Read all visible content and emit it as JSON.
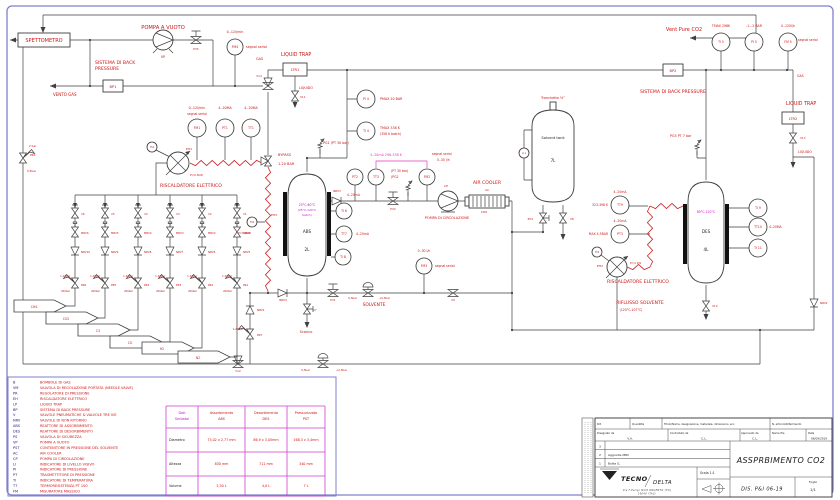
{
  "sheet": {
    "width": 840,
    "height": 500,
    "drawing_number": "DIS. P&I 06-19",
    "drawing_title": "ASSPRBIMENTO CO2"
  },
  "colors": {
    "line": "#3f3f3f",
    "r": "#cc1414",
    "m": "#c213c2",
    "p": "#e23bbf",
    "k": "#1c1c1c",
    "n": "#20207a",
    "border": "#8080cc"
  },
  "labels": [
    [
      "SPETTOMETRO",
      44,
      42,
      "r",
      5,
      "m"
    ],
    [
      "POMPA A VUOTO",
      163,
      29,
      "r",
      5.2,
      "m"
    ],
    [
      "VP",
      163,
      58,
      "r",
      3.4,
      "m"
    ],
    [
      "PV5",
      196,
      50,
      "r",
      2.8,
      "m"
    ],
    [
      "0..12l/min",
      235,
      33,
      "r",
      3.3,
      "m"
    ],
    [
      "segnal serial",
      246,
      48,
      "r",
      3.3,
      "s"
    ],
    [
      "SISTEMA DI BACK",
      95,
      64,
      "r",
      4.6,
      "s"
    ],
    [
      "PRESSURE",
      95,
      70,
      "r",
      4.6,
      "s"
    ],
    [
      "BP1",
      113,
      88,
      "r",
      3.6,
      "m"
    ],
    [
      "VENTO GAS",
      53,
      96,
      "r",
      4,
      "s"
    ],
    [
      "2 bar",
      29,
      147,
      "r",
      2.8,
      "s"
    ],
    [
      "PR0",
      30,
      156,
      "r",
      2.8,
      "s"
    ],
    [
      "0,5bar",
      27,
      172,
      "r",
      2.8,
      "s"
    ],
    [
      "GAS",
      256,
      60,
      "r",
      3.4,
      "s"
    ],
    [
      "LIQUID TRAP",
      281,
      56,
      "r",
      4.8,
      "s"
    ],
    [
      "LTR1",
      295,
      71,
      "r",
      3.6,
      "m"
    ],
    [
      "LIQUIDO",
      299,
      89,
      "r",
      3.3,
      "s"
    ],
    [
      "V11",
      300,
      98,
      "r",
      2.8,
      "s"
    ],
    [
      "V14",
      259,
      77,
      "r",
      2.8,
      "m"
    ],
    [
      "BYPASS",
      278,
      156,
      "r",
      3.5,
      "s"
    ],
    [
      "1-20 BAR",
      278,
      165,
      "r",
      3.5,
      "s"
    ],
    [
      "PG1 (PT 30 bar)",
      323,
      144,
      "r",
      3.3,
      "s"
    ],
    [
      "PMAX 20 BAR",
      380,
      100,
      "r",
      3.3,
      "s"
    ],
    [
      "TMAX 338 K",
      380,
      129,
      "r",
      3.3,
      "s"
    ],
    [
      "(358 K batch)",
      380,
      135,
      "r",
      3.1,
      "s"
    ],
    [
      "0..12l/min",
      197,
      109,
      "r",
      3.3,
      "m"
    ],
    [
      "segnal serial",
      197,
      115,
      "r",
      3.1,
      "m"
    ],
    [
      "4..20MA",
      225,
      109,
      "r",
      3.3,
      "m"
    ],
    [
      "4..20MA",
      251,
      109,
      "r",
      3.3,
      "m"
    ],
    [
      "RISCALDATORE ELETTRICO",
      160,
      187,
      "r",
      4.6,
      "s"
    ],
    [
      "EH1",
      186,
      150,
      "r",
      3,
      "s"
    ],
    [
      "P=0,5kW",
      190,
      176,
      "r",
      2.8,
      "s"
    ],
    [
      "EH3",
      271,
      216,
      "r",
      3,
      "s"
    ],
    [
      "P=1,0kW",
      238,
      234,
      "r",
      2.8,
      "s"
    ],
    [
      "Vent Pure CO2",
      684,
      31,
      "r",
      5,
      "m"
    ],
    [
      "TMAX 298K",
      721,
      27,
      "r",
      3.2,
      "m"
    ],
    [
      "-1...2 BAR",
      754,
      27,
      "r",
      3.2,
      "m"
    ],
    [
      "0..120l/h",
      788,
      27,
      "r",
      3.2,
      "m"
    ],
    [
      "segnal serial",
      798,
      41,
      "r",
      3.1,
      "s"
    ],
    [
      "BP2",
      673,
      72,
      "r",
      3.6,
      "m"
    ],
    [
      "SISTEMA DI BACK PRESSURE",
      640,
      93,
      "r",
      4.6,
      "s"
    ],
    [
      "GAS",
      797,
      77,
      "r",
      3.2,
      "s"
    ],
    [
      "LIQUID TRAP",
      786,
      105,
      "r",
      4.8,
      "s"
    ],
    [
      "LTR2",
      793,
      120,
      "r",
      3.6,
      "m"
    ],
    [
      "V13",
      800,
      139,
      "r",
      2.8,
      "s"
    ],
    [
      "LIQUIDO",
      798,
      153,
      "r",
      3.3,
      "s"
    ],
    [
      "Tronchetto ½”",
      553,
      99,
      "r",
      3.4,
      "m"
    ],
    [
      "Solvent tank",
      553,
      139,
      "k",
      3.7,
      "m"
    ],
    [
      "7L",
      553,
      162,
      "k",
      4,
      "m"
    ],
    [
      "PG3  PT 7 bar",
      670,
      137,
      "r",
      3.3,
      "s"
    ],
    [
      "PV4",
      533,
      220,
      "r",
      2.8,
      "e"
    ],
    [
      "V8",
      570,
      220,
      "r",
      2.8,
      "s"
    ],
    [
      "NRV3",
      337,
      192,
      "r",
      2.8,
      "m"
    ],
    [
      "4..20mA",
      347,
      196,
      "r",
      3.1,
      "s"
    ],
    [
      "(PT 30 bar)",
      391,
      172,
      "r",
      3.1,
      "s"
    ],
    [
      "(PG2",
      391,
      178,
      "r",
      3.1,
      "s"
    ],
    [
      "4..20mA  298-338 K",
      370,
      156,
      "p",
      3.3,
      "s"
    ],
    [
      "segnal serial",
      432,
      155,
      "r",
      3.1,
      "s"
    ],
    [
      "0..30 l/h",
      437,
      161,
      "r",
      3.1,
      "s"
    ],
    [
      "PV2",
      393,
      210,
      "r",
      2.8,
      "m"
    ],
    [
      "CP",
      446,
      187,
      "r",
      3,
      "m"
    ],
    [
      "POMPA DI CIRCOLAZIONE",
      447,
      219,
      "r",
      3.5,
      "m"
    ],
    [
      "AIR COOLER",
      487,
      184,
      "r",
      4.6,
      "m"
    ],
    [
      "AC",
      487,
      191,
      "r",
      2.9,
      "m"
    ],
    [
      "CHO",
      484,
      213,
      "r",
      2.9,
      "m"
    ],
    [
      "25°C-60°C",
      307,
      206,
      "m",
      3.1,
      "m"
    ],
    [
      "(25°C-120°C",
      307,
      211,
      "m",
      2.9,
      "m"
    ],
    [
      "batch)",
      307,
      216,
      "m",
      2.9,
      "m"
    ],
    [
      "ABS",
      307,
      233,
      "k",
      4.1,
      "m"
    ],
    [
      "2L",
      307,
      251,
      "k",
      4.1,
      "m"
    ],
    [
      "80°C-120°C",
      706,
      213,
      "m",
      3.1,
      "m"
    ],
    [
      "DES",
      706,
      233,
      "k",
      4.1,
      "m"
    ],
    [
      "4L",
      706,
      251,
      "k",
      4.1,
      "m"
    ],
    [
      "4..20mA",
      356,
      235,
      "r",
      3.1,
      "s"
    ],
    [
      "NRV4",
      283,
      301,
      "r",
      2.8,
      "m"
    ],
    [
      "V7",
      313,
      311,
      "r",
      2.8,
      "s"
    ],
    [
      "Scarico",
      306,
      333,
      "r",
      3.5,
      "m"
    ],
    [
      "PV1",
      333,
      301,
      "r",
      2.8,
      "m"
    ],
    [
      "0,5bar",
      357,
      299,
      "r",
      2.7,
      "e"
    ],
    [
      "+0,5bar",
      379,
      299,
      "r",
      2.7,
      "s"
    ],
    [
      "SOLVENTE",
      374,
      306,
      "r",
      4.4,
      "m"
    ],
    [
      "0..30 l/h",
      424,
      252,
      "r",
      3.1,
      "m"
    ],
    [
      "segnal serial",
      435,
      267,
      "r",
      3.1,
      "s"
    ],
    [
      "V9",
      453,
      301,
      "r",
      2.8,
      "m"
    ],
    [
      "4..20mA",
      620,
      193,
      "r",
      3.1,
      "m"
    ],
    [
      "323-398 K",
      608,
      206,
      "r",
      3.1,
      "e"
    ],
    [
      "4..20mA",
      620,
      222,
      "r",
      3.1,
      "m"
    ],
    [
      "MAX 4,5BAR",
      608,
      235,
      "r",
      3.1,
      "e"
    ],
    [
      "EH2",
      603,
      267,
      "r",
      3,
      "e"
    ],
    [
      "P=4 kW",
      630,
      264,
      "r",
      2.8,
      "s"
    ],
    [
      "RISCALDATORE ELETTRICO",
      607,
      283,
      "r",
      4.6,
      "s"
    ],
    [
      "RIFLUSSO SOLVENTE",
      640,
      304,
      "r",
      4.6,
      "m"
    ],
    [
      "(120°C-107°C)",
      631,
      311,
      "r",
      3.1,
      "m"
    ],
    [
      "4..20MA",
      769,
      228,
      "r",
      3.1,
      "s"
    ],
    [
      "V10",
      712,
      307,
      "r",
      2.8,
      "s"
    ],
    [
      "NRV2",
      820,
      304,
      "r",
      2.8,
      "s"
    ],
    [
      "NRV1",
      257,
      311,
      "r",
      2.8,
      "s"
    ],
    [
      "1-20bar",
      243,
      330,
      "r",
      2.7,
      "e"
    ],
    [
      "PR7",
      257,
      336,
      "r",
      2.8,
      "s"
    ],
    [
      "V12",
      238,
      372,
      "r",
      2.8,
      "m"
    ],
    [
      "0,5bar",
      310,
      371,
      "r",
      2.7,
      "e"
    ],
    [
      "+2,5bar",
      336,
      371,
      "r",
      2.7,
      "s"
    ],
    [
      "V6",
      81,
      215,
      "r",
      2.7,
      "s"
    ],
    [
      "V5",
      111,
      215,
      "r",
      2.7,
      "s"
    ],
    [
      "V4",
      144,
      215,
      "r",
      2.7,
      "s"
    ],
    [
      "V3",
      176,
      215,
      "r",
      2.7,
      "s"
    ],
    [
      "V2",
      208,
      215,
      "r",
      2.7,
      "s"
    ],
    [
      "V1",
      243,
      215,
      "r",
      2.7,
      "s"
    ],
    [
      "MRV6",
      81,
      234,
      "r",
      2.7,
      "s"
    ],
    [
      "MRV5",
      111,
      234,
      "r",
      2.7,
      "s"
    ],
    [
      "MRV4",
      144,
      234,
      "r",
      2.7,
      "s"
    ],
    [
      "MRV3",
      176,
      234,
      "r",
      2.7,
      "s"
    ],
    [
      "MRV2",
      208,
      234,
      "r",
      2.7,
      "s"
    ],
    [
      "MRV1",
      243,
      234,
      "r",
      2.7,
      "s"
    ],
    [
      "NRV10",
      81,
      253,
      "r",
      2.7,
      "s"
    ],
    [
      "NRV9",
      111,
      253,
      "r",
      2.7,
      "s"
    ],
    [
      "NRV8",
      144,
      253,
      "r",
      2.7,
      "s"
    ],
    [
      "NRV7",
      176,
      253,
      "r",
      2.7,
      "s"
    ],
    [
      "NRV6",
      208,
      253,
      "r",
      2.7,
      "s"
    ],
    [
      "NRV5",
      243,
      253,
      "r",
      2.7,
      "s"
    ],
    [
      "PR6",
      81,
      286,
      "r",
      2.7,
      "s"
    ],
    [
      "PR5",
      111,
      286,
      "r",
      2.7,
      "s"
    ],
    [
      "PR4",
      144,
      286,
      "r",
      2.7,
      "s"
    ],
    [
      "PR3",
      176,
      286,
      "r",
      2.7,
      "s"
    ],
    [
      "PR2",
      208,
      286,
      "r",
      2.7,
      "s"
    ],
    [
      "PR1",
      243,
      286,
      "r",
      2.7,
      "s"
    ],
    [
      "1-20bar",
      70,
      277,
      "r",
      2.5,
      "e"
    ],
    [
      "1-20bar",
      100,
      277,
      "r",
      2.5,
      "e"
    ],
    [
      "1-20bar",
      133,
      277,
      "r",
      2.5,
      "e"
    ],
    [
      "1-20bar",
      165,
      277,
      "r",
      2.5,
      "e"
    ],
    [
      "1-20bar",
      197,
      277,
      "r",
      2.5,
      "e"
    ],
    [
      "1-20bar",
      232,
      277,
      "r",
      2.5,
      "e"
    ],
    [
      "200bar",
      70,
      292,
      "r",
      2.5,
      "e"
    ],
    [
      "200bar",
      100,
      292,
      "r",
      2.5,
      "e"
    ],
    [
      "200bar",
      133,
      292,
      "r",
      2.5,
      "e"
    ],
    [
      "200bar",
      165,
      292,
      "r",
      2.5,
      "e"
    ],
    [
      "200bar",
      197,
      292,
      "r",
      2.5,
      "e"
    ],
    [
      "200bar",
      232,
      292,
      "r",
      2.5,
      "e"
    ],
    [
      "CH4",
      34,
      308,
      "r",
      3.1,
      "m"
    ],
    [
      "CO2",
      66,
      320,
      "r",
      3.1,
      "m"
    ],
    [
      "C3",
      98,
      332,
      "r",
      3.1,
      "m"
    ],
    [
      "CO",
      130,
      344,
      "r",
      3.1,
      "m"
    ],
    [
      "H2",
      162,
      350,
      "r",
      3.1,
      "m"
    ],
    [
      "N2",
      198,
      359,
      "r",
      3.1,
      "m"
    ]
  ],
  "instruments": [
    [
      "FM4",
      235,
      47,
      8
    ],
    [
      "FM1",
      197,
      128,
      9
    ],
    [
      "PT1",
      225,
      128,
      9
    ],
    [
      "TT1",
      251,
      128,
      9
    ],
    [
      "PI 4",
      366,
      99,
      9
    ],
    [
      "TI 4",
      366,
      131,
      9
    ],
    [
      "TI 5",
      721,
      42,
      9
    ],
    [
      "PI 5",
      754,
      42,
      9
    ],
    [
      "FM 5",
      788,
      42,
      9
    ],
    [
      "PT2",
      355,
      177,
      8
    ],
    [
      "TT3",
      376,
      177,
      8
    ],
    [
      "FM2",
      427,
      177,
      8
    ],
    [
      "TI 6",
      344,
      211,
      8
    ],
    [
      "TT7",
      344,
      234,
      8
    ],
    [
      "TI 8",
      343,
      257,
      8
    ],
    [
      "FM3",
      424,
      266,
      8
    ],
    [
      "TT9",
      620,
      205,
      9
    ],
    [
      "PT3",
      620,
      234,
      9
    ],
    [
      "TI 9",
      758,
      208,
      9
    ],
    [
      "TT10",
      758,
      227,
      9
    ],
    [
      "TI 11",
      758,
      248,
      9
    ],
    [
      "TS1",
      152,
      147,
      5
    ],
    [
      "TS2",
      252,
      222,
      5
    ],
    [
      "TS3",
      597,
      252,
      5
    ],
    [
      "LI 1",
      524,
      153,
      5
    ]
  ],
  "legend": {
    "items": [
      [
        "B",
        "BOMBOLE DI GAS"
      ],
      [
        "VM",
        "VALVOLA DI REGOLAZIONE PORTATA (NEEDLE VALVE)"
      ],
      [
        "PR",
        "REGOLATORE DI PRESSIONE"
      ],
      [
        "EH",
        "RISCALDATORE ELETTRICO"
      ],
      [
        "LP",
        "LIQUID TRAP"
      ],
      [
        "BP",
        "SISTEMA DI BACK PRESSURE"
      ],
      [
        "V",
        "VALVOLE PNEUMATICHE & VALVOLE TRE VIE"
      ],
      [
        "NRV",
        "VALVOLE DI NON RITORNO"
      ],
      [
        "ABS",
        "REATTORE DI ASSORBIMENTO"
      ],
      [
        "DES",
        "REATTORE DI DESORBIMENTO"
      ],
      [
        "PS",
        "VALVOLA DI SICUREZZA"
      ],
      [
        "VP",
        "POMPA A VUOTO"
      ],
      [
        "PST",
        "CONTENITORE IN PRESSIONE DEL SOLVENTE"
      ],
      [
        "AC",
        "AIR COOLER"
      ],
      [
        "CP",
        "POMPA DI CIRCOLAZIONE"
      ],
      [
        "LI",
        "INDICATORE DI LIVELLO VISIVO"
      ],
      [
        "PI",
        "INDICATORE DI PRESSIONE"
      ],
      [
        "PT",
        "TRASMETTITORE DI PRESSIONE"
      ],
      [
        "TI",
        "INDICATORE DI TEMPERATURA"
      ],
      [
        "TT",
        "TERMORESISTENZA PT 100"
      ],
      [
        "FM",
        "MISURATORE MASSICO"
      ]
    ]
  },
  "tank_table": {
    "corner": [
      "Dati",
      "Serbatoi"
    ],
    "cols": [
      [
        "Assorbimento",
        "ABS"
      ],
      [
        "Desorbimento",
        "DES"
      ],
      [
        "Pressurizzato",
        "PST"
      ]
    ],
    "rows": [
      {
        "label": "Diametro",
        "values": [
          "73,02 x 2,77 mm",
          "86,9 x 3,05mm",
          "168,3 x 3,4mm"
        ]
      },
      {
        "label": "Altezza",
        "values": [
          "830 mm",
          "711 mm",
          "340 mm"
        ]
      },
      {
        "label": "Volume",
        "values": [
          "2,30 L",
          "4,0 L",
          "7 L"
        ]
      }
    ]
  },
  "title_block": {
    "rif": "Rif.",
    "quantita": "Quantità",
    "titolo": "Titolo/Nome, designazione, materiale, dimensioni, ecc.",
    "articolo": "N. articolo/Riferimento",
    "disegnato": "Disegnato da",
    "disegnato_val": "V.A.",
    "controllato": "Controllato da",
    "controllato_val": "C.L.",
    "approvato": "Approvato da",
    "approvato_val": "C.L.",
    "nome_file": "Nome file",
    "data_label": "Data",
    "data_val": "06/09/2019",
    "revisions": [
      {
        "n": "3",
        "text": ""
      },
      {
        "n": "2",
        "text": "Aggiunte MRV"
      },
      {
        "n": "1",
        "text": "Butta G."
      }
    ],
    "scala": "Scala  1:1",
    "logo_top": "TECNO",
    "logo_bottom": "DELTA",
    "address1": "Via F.Parigi N3/6  DRUENTO (TO)",
    "address2": "10040  ITALY",
    "title": "ASSPRBIMENTO CO2",
    "dis": "DIS. P&I 06-19",
    "foglio_label": "Foglio",
    "foglio_val": "1/1"
  }
}
